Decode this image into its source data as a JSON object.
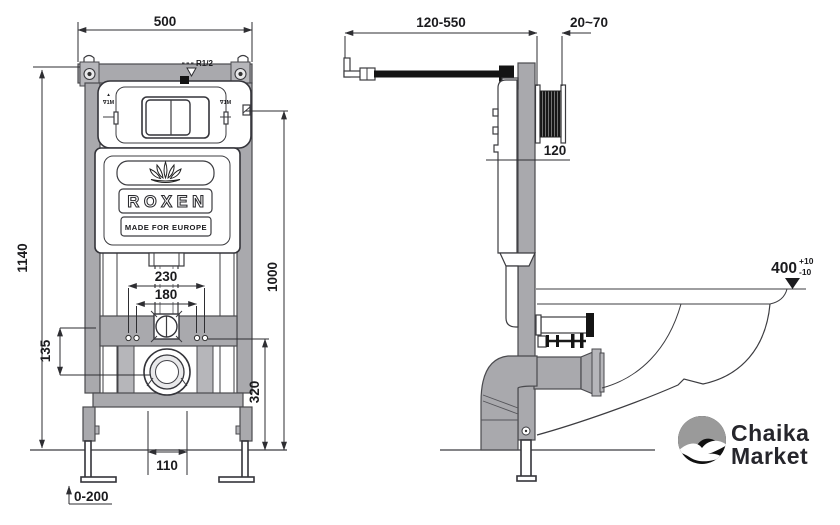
{
  "front_view": {
    "dim_width": "500",
    "dim_height": "1140",
    "dim_outer_holes": "230",
    "dim_inner_holes": "180",
    "dim_crossbar": "135",
    "dim_holes_floor": "320",
    "dim_plate_floor": "1000",
    "dim_drain": "110",
    "dim_feet": "0-200",
    "label_inlet": "R1/2",
    "label_mark_left_top": "▲",
    "label_mark_left": "∇1M",
    "label_mark_right": "∇1M",
    "brand": "ROXEN",
    "tagline": "MADE FOR EUROPE"
  },
  "side_view": {
    "dim_bracket": "120-550",
    "dim_wall": "20~70",
    "dim_inlet_offset": "120",
    "dim_bowl_height": "400",
    "dim_bowl_tol_plus": "+10",
    "dim_bowl_tol_minus": "-10"
  },
  "logo": {
    "line1": "Chaika",
    "line2": "Market"
  },
  "colors": {
    "line": "#3c3c40",
    "metal": "#a9a9ad",
    "black": "#141414",
    "text": "#1b1b1e",
    "logo_gray": "#9a9a9a",
    "logo_black": "#111111"
  }
}
